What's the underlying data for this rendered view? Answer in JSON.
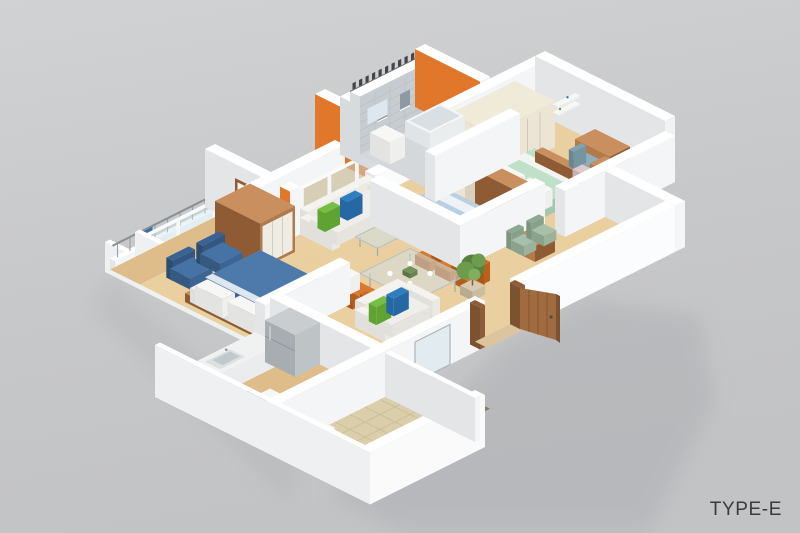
{
  "caption": {
    "label": "TYPE-E"
  },
  "colors": {
    "bg1": "#d1d2d3",
    "bg2": "#c7c8c9",
    "bg3": "#c2c3c5",
    "shadow": "#adafb2",
    "wallTop": "#ffffff",
    "wallSW": "#e3e5e7",
    "wallSE": "#f4f5f6",
    "extSW": "#eef0f1",
    "extSE": "#fafafb",
    "orange": "#e0772b",
    "orangeHi": "#f0954a",
    "bathPaint": "#d8dbde",
    "bathTile": "#c7ccd1",
    "bathTileLine": "#b9bfc5",
    "bathWin": "#8f99a3",
    "bathFloor": "#d4d8da",
    "dark": "#43474b",
    "wood": "#eacfa0",
    "wood2": "#dfbd8a",
    "tileFloor": "#dbcfab",
    "tileGrout": "#c9bd96",
    "woodDark": "#8f5b35",
    "woodMid": "#b07a4c",
    "woodLight": "#c98f5e",
    "cream": "#ece5d6",
    "creamD": "#d9d0bd",
    "blueBed": "#4d7aab",
    "blueBedD": "#3c6290",
    "blueBedD2": "#446e9d",
    "blueChair": "#3e6da3",
    "blueChairD": "#33597f",
    "bed2": "#b9d0e2",
    "bed2D": "#9fb8cb",
    "mint": "#c0e0c9",
    "mintD": "#a6c6ae",
    "sofa": "#f4f3f0",
    "sofaD": "#e2e0da",
    "pGreen": "#76bd43",
    "pGreenD": "#5fa332",
    "pBlue": "#2f7ec0",
    "pBlueD": "#2568a3",
    "glass": "#cde2ea",
    "steel": "#9fa8ad",
    "fridgeT": "#c9cdd0",
    "fridgeSW": "#a7adb1",
    "fridgeSE": "#bec3c6",
    "rug": "#8d7c63",
    "rug2": "#9e8d72",
    "plant": "#6d9c4f",
    "plantD": "#577f3d",
    "sage": "#a8bfa9",
    "sageD": "#8fa892",
    "door": "#a06b3f",
    "doorEdge": "#7c5230",
    "doorFrame": "#8d5c39",
    "caption": "#3b3b3c"
  }
}
